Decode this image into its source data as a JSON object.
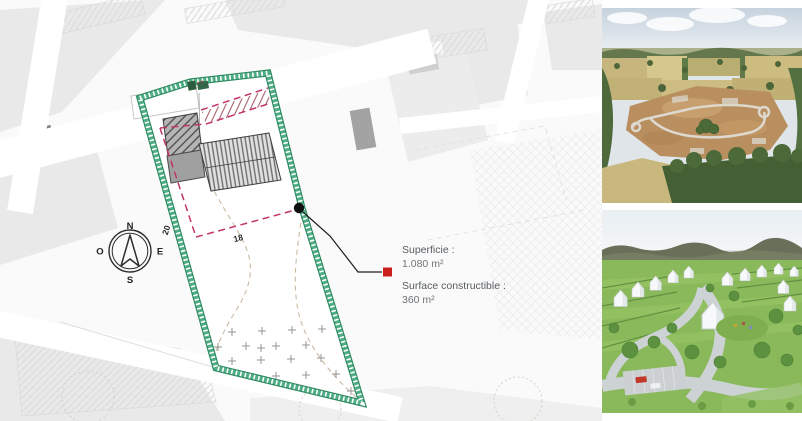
{
  "plan": {
    "compass": {
      "north": "N",
      "east": "E",
      "south": "S",
      "west": "O"
    },
    "dimensions": {
      "side_length": "20",
      "front_length": "18"
    },
    "callout": {
      "area_label": "Superficie :",
      "area_value": "1.080 m²",
      "buildable_label": "Surface constructible :",
      "buildable_value": "360 m²"
    },
    "colors": {
      "boundary_green": "#2e8a60",
      "boundary_green_light": "#4fae85",
      "constructible_pink": "#c2356b",
      "marker_red": "#cc1f1f",
      "annotation_text": "#575c60"
    }
  },
  "photos": {
    "aerial": {
      "name": "aerial-drone-photo"
    },
    "render": {
      "name": "masterplan-render-photo"
    }
  }
}
